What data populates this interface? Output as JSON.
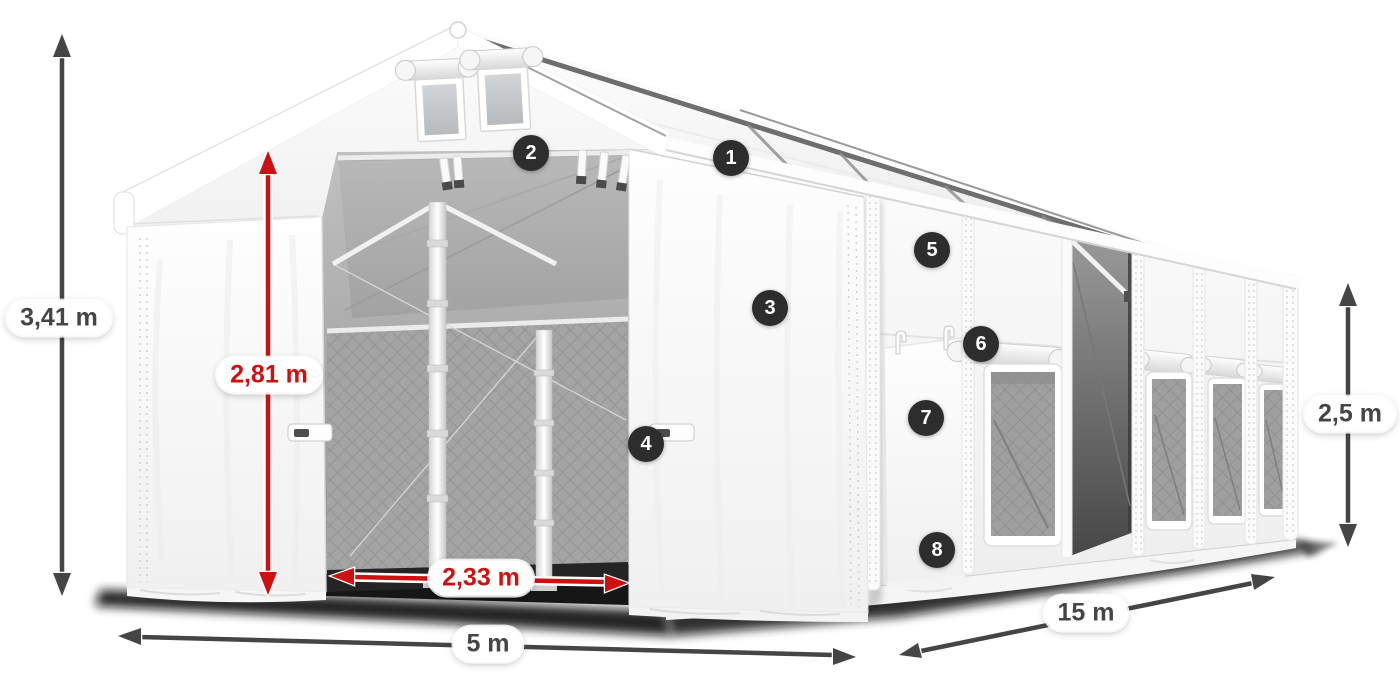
{
  "dimensions": {
    "total_height": {
      "label": "3,41 m"
    },
    "clearance_height": {
      "label": "2,81 m"
    },
    "door_width": {
      "label": "2,33 m"
    },
    "front_width": {
      "label": "5 m"
    },
    "side_length": {
      "label": "15 m"
    },
    "side_wall_height": {
      "label": "2,5 m"
    }
  },
  "markers": {
    "m1": "1",
    "m2": "2",
    "m3": "3",
    "m4": "4",
    "m5": "5",
    "m6": "6",
    "m7": "7",
    "m8": "8"
  },
  "colors": {
    "dimension_red": "#cf1010",
    "dimension_gray": "#454545",
    "badge_bg": "#2d2d2d",
    "badge_text": "#ffffff"
  }
}
